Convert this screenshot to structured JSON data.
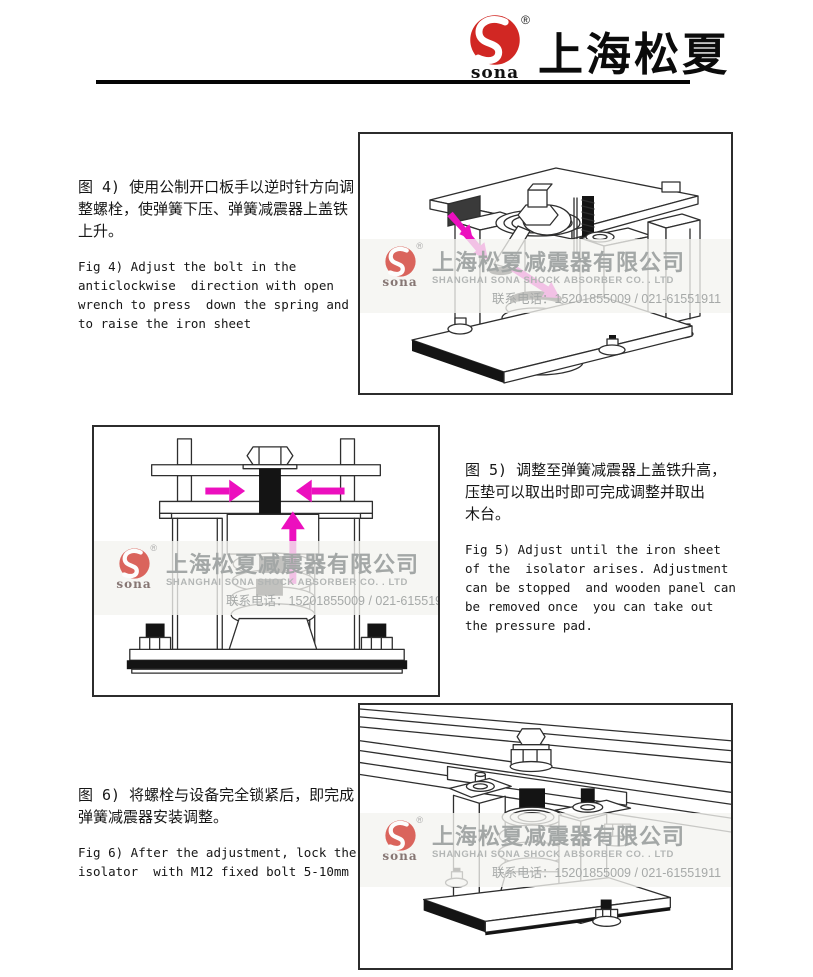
{
  "header": {
    "brand": "上海松夏",
    "logo_text": "sona",
    "registered": "®"
  },
  "watermark": {
    "logo_text": "sona",
    "registered": "®",
    "company_cn": "上海松夏减震器有限公司",
    "company_en": "SHANGHAI SONA SHOCK ABSORBER CO. . LTD",
    "phone": "联系电话：15201855009 / 021-61551911"
  },
  "figures": [
    {
      "id": "fig4",
      "caption_cn": "图 4) 使用公制开口板手以逆时针方向调\n整螺栓，使弹簧下压、弹簧减震器上盖铁\n上升。",
      "caption_en": "Fig 4) Adjust the bolt in the\nanticlockwise  direction with open\nwrench to press  down the spring and\nto raise the iron sheet"
    },
    {
      "id": "fig5",
      "caption_cn": "图 5) 调整至弹簧减震器上盖铁升高，\n压垫可以取出时即可完成调整并取出\n木台。",
      "caption_en": "Fig 5) Adjust until the iron sheet\nof the  isolator arises. Adjustment\ncan be stopped  and wooden panel can\nbe removed once  you can take out\nthe pressure pad."
    },
    {
      "id": "fig6",
      "caption_cn": "图 6) 将螺栓与设备完全锁紧后，即完成\n弹簧减震器安装调整。",
      "caption_en": "Fig 6) After the adjustment, lock the\nisolator  with M12 fixed bolt 5-10mm"
    }
  ],
  "colors": {
    "brand_red": "#d12723",
    "arrow_magenta": "#ec0fbe",
    "watermark_gray": "#a3a7a6",
    "drawing_stroke": "#2e2e2e"
  }
}
